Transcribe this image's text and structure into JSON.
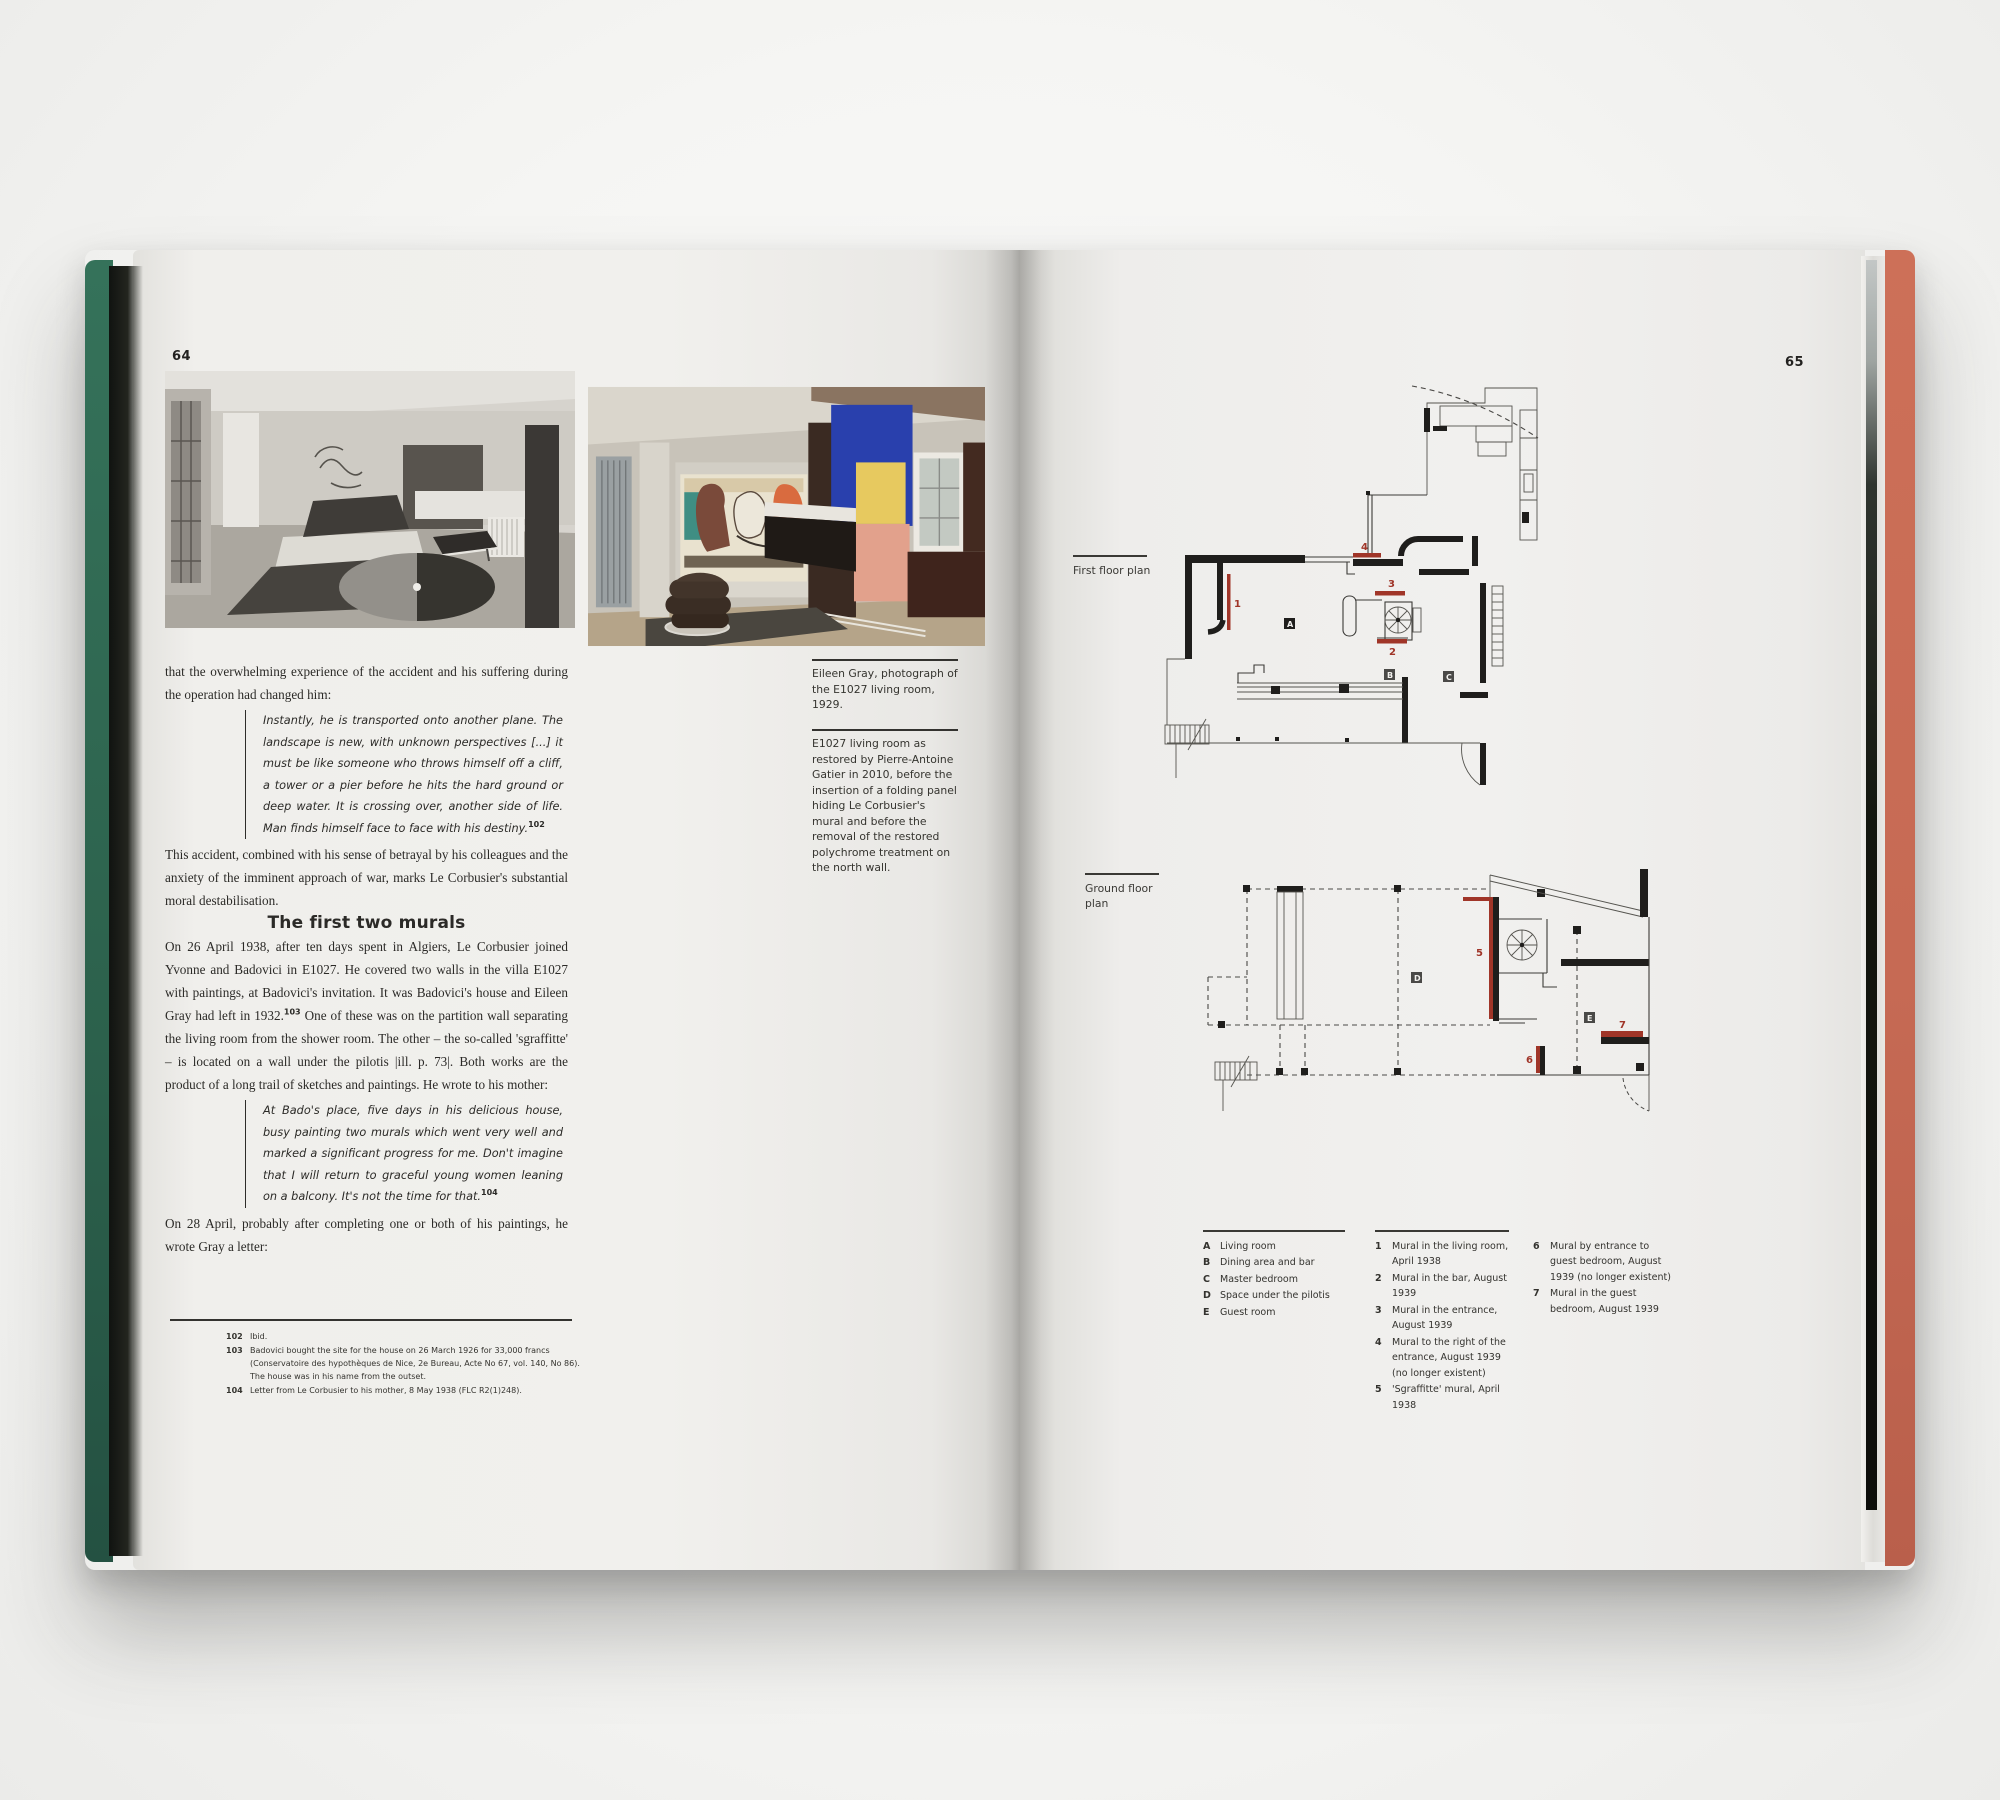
{
  "colors": {
    "cover_left_green": "#2e6b54",
    "cover_right_salmon": "#c66a54",
    "plan_mural_red": "#a03528",
    "page_paper": "#f0efec",
    "ink": "#2b2a27"
  },
  "page_left": {
    "number": "64",
    "body": {
      "intro": "that the overwhelming experience of the accident and his suffering during the operation had changed him:",
      "quote1": "Instantly, he is transported onto another plane. The landscape is new, with unknown perspectives [...] it must be like someone who throws himself off a cliff, a tower or a pier before he hits the hard ground or deep water. It is crossing over, another side of life. Man finds himself face to face with his destiny.",
      "quote1_ref": "102",
      "para2": "This accident, combined with his sense of betrayal by his colleagues and the anxiety of the imminent approach of war, marks Le Corbusier's substantial moral destabilisation.",
      "heading": "The first two murals",
      "para3_a": "On 26 April 1938, after ten days spent in Algiers, Le Corbusier joined Yvonne and Badovici in E1027. He covered two walls in the villa E1027 with paintings, at Badovici's invitation. It was Badovici's house and Eileen Gray had left in 1932.",
      "para3_ref": "103",
      "para3_b": " One of these was on the partition wall separating the living room from the shower room. The other – the so-called 'sgraffitte' – is located on a wall under the pilotis |ill. p. 73|. Both works are the product of a long trail of sketches and paintings. He wrote to his mother:",
      "quote2": "At Bado's place, five days in his delicious house, busy painting two murals which went very well and marked a significant progress for me. Don't imagine that I will return to graceful young women leaning on a balcony. It's not the time for that.",
      "quote2_ref": "104",
      "para4": "On 28 April, probably after completing one or both of his paintings, he wrote Gray a letter:"
    },
    "captions": [
      {
        "text": "Eileen Gray, photograph of the E1027 living room, 1929."
      },
      {
        "text": "E1027 living room as restored by Pierre-Antoine Gatier in 2010, before the insertion of a folding panel hiding Le Corbusier's mural and before the removal of the restored polychrome treatment on the north wall."
      }
    ],
    "footnotes": [
      {
        "num": "102",
        "text": "Ibid."
      },
      {
        "num": "103",
        "text": "Badovici bought the site for the house on 26 March 1926 for 33,000 francs (Conservatoire des hypothèques de Nice, 2e Bureau, Acte No 67, vol. 140, No 86). The house was in his name from the outset."
      },
      {
        "num": "104",
        "text": "Letter from Le Corbusier to his mother, 8 May 1938 (FLC R2(1)248)."
      }
    ]
  },
  "page_right": {
    "number": "65",
    "plan_labels": {
      "first": "First floor plan",
      "ground": "Ground floor plan"
    },
    "legend": {
      "letters": [
        {
          "key": "A",
          "text": "Living room"
        },
        {
          "key": "B",
          "text": "Dining area and bar"
        },
        {
          "key": "C",
          "text": "Master bedroom"
        },
        {
          "key": "D",
          "text": "Space under the pilotis"
        },
        {
          "key": "E",
          "text": "Guest room"
        }
      ],
      "numbers": [
        {
          "key": "1",
          "text": "Mural in the living room, April 1938"
        },
        {
          "key": "2",
          "text": "Mural in the bar, August 1939"
        },
        {
          "key": "3",
          "text": "Mural in the entrance, August 1939"
        },
        {
          "key": "4",
          "text": "Mural to the right of the entrance, August 1939 (no longer existent)"
        },
        {
          "key": "5",
          "text": "'Sgraffitte' mural, April 1938"
        },
        {
          "key": "6",
          "text": "Mural by entrance to guest bedroom, August 1939 (no longer existent)"
        },
        {
          "key": "7",
          "text": "Mural in the guest bedroom, August 1939"
        }
      ]
    }
  }
}
